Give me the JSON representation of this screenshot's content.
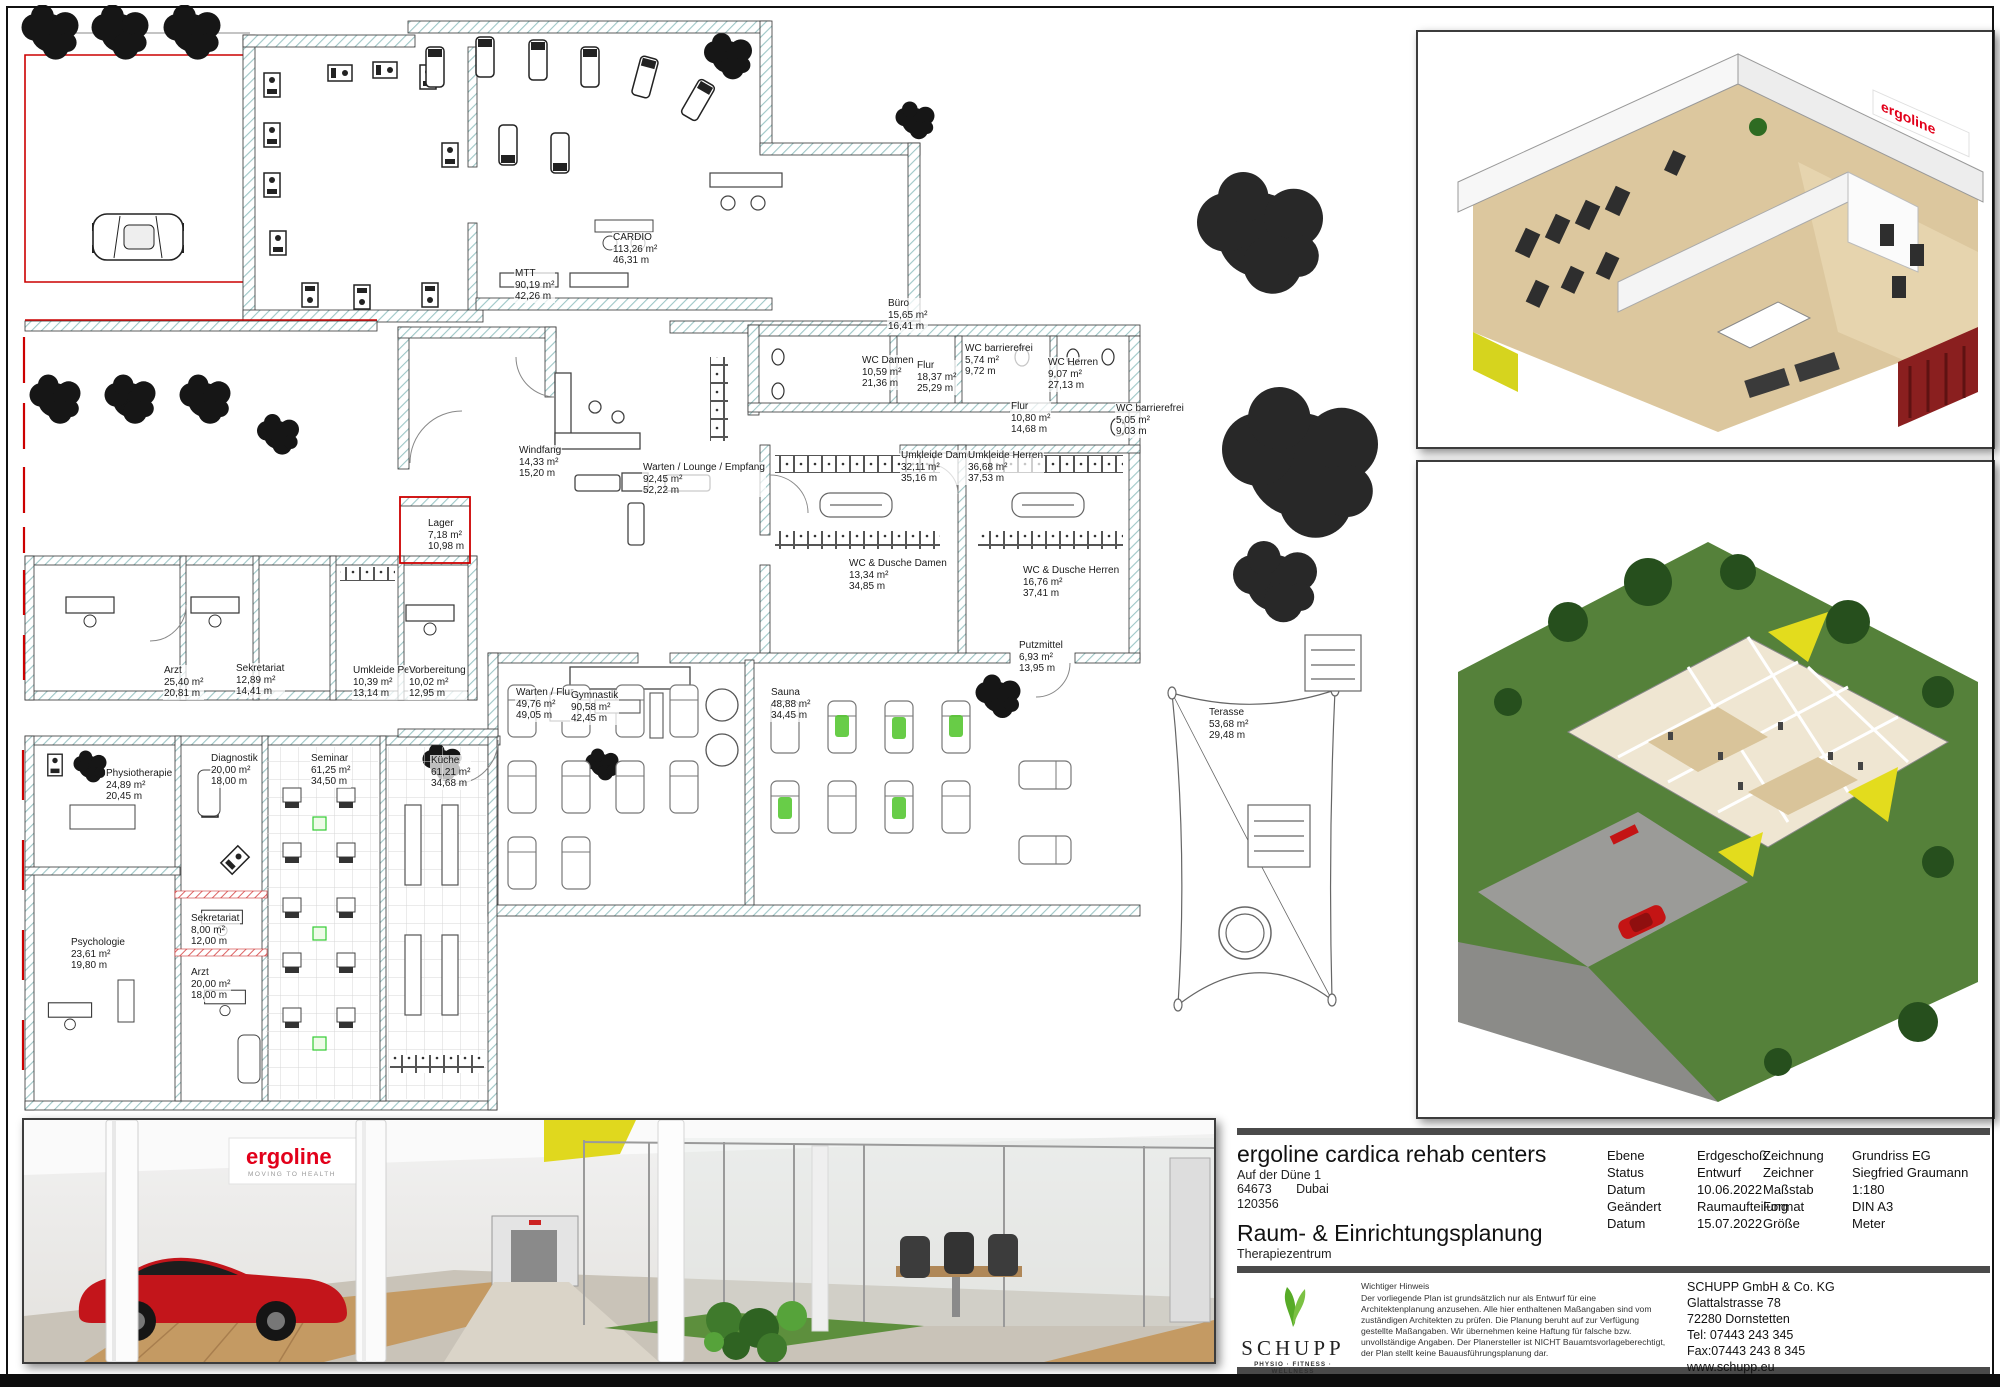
{
  "titleblock": {
    "project_name": "ergoline cardica rehab centers",
    "address_line": "Auf der Düne 1",
    "postal_code": "64673",
    "city": "Dubai",
    "project_number": "120356",
    "plan_title": "Raum- & Einrichtungsplanung",
    "plan_subtitle": "Therapiezentrum",
    "fields_left": [
      {
        "label": "Ebene",
        "value": "Erdgeschoß"
      },
      {
        "label": "Status",
        "value": "Entwurf"
      },
      {
        "label": "Datum",
        "value": "10.06.2022"
      },
      {
        "label": "Geändert",
        "value": "Raumaufteilung"
      },
      {
        "label": "Datum",
        "value": "15.07.2022"
      }
    ],
    "fields_right": [
      {
        "label": "Zeichnung",
        "value": "Grundriss EG"
      },
      {
        "label": "Zeichner",
        "value": "Siegfried Graumann"
      },
      {
        "label": "Maßstab",
        "value": "1:180"
      },
      {
        "label": "Format",
        "value": "DIN A3"
      },
      {
        "label": "Größe",
        "value": "Meter"
      }
    ]
  },
  "company": {
    "logo_name": "SCHUPP",
    "logo_tagline": "PHYSIO · FITNESS · WELLNESS",
    "notice_title": "Wichtiger Hinweis",
    "notice_text": "Der vorliegende Plan ist grundsätzlich nur als Entwurf für eine Architektenplanung anzusehen. Alle hier enthaltenen Maßangaben sind vom zuständigen Architekten zu prüfen. Die Planung beruht auf zur Verfügung gestellte Maßangaben. Wir übernehmen keine Haftung für falsche bzw. unvollständige Angaben. Der Planersteller ist NICHT Bauamtsvorlageberechtigt, der Plan stellt keine Bauausführungsplanung dar.",
    "address": [
      "SCHUPP GmbH & Co. KG",
      "Glattalstrasse 78",
      "72280 Dornstetten",
      "Tel: 07443 243 345",
      "Fax:07443 243 8 345",
      "www.schupp.eu"
    ]
  },
  "legal": "Alle Rechte vorbehalten. Kein Teil dieser Unterlagen darf in irgendeiner Form (Druck, Fotokopie oder einem anderen Verfahren) ohne schriftliche Genehmigung des Erstellers reproduziert oder unter Verwendung elektronischer Systeme verarbeitet, vervielfältigt und an Dritte weitergegeben werden.",
  "brand": {
    "ergoline_logo": "ergoline",
    "ergoline_tagline": "MOVING TO HEALTH",
    "ergoline_red": "#e2001a",
    "schupp_green": "#57ab27"
  },
  "floorplan": {
    "rooms": [
      {
        "name": "MTT",
        "area": "90,19 m²",
        "perimeter": "42,26 m",
        "x": 504,
        "y": 263
      },
      {
        "name": "CARDIO",
        "area": "113,26 m²",
        "perimeter": "46,31 m",
        "x": 602,
        "y": 227
      },
      {
        "name": "Büro",
        "area": "15,65 m²",
        "perimeter": "16,41 m",
        "x": 877,
        "y": 293
      },
      {
        "name": "WC Damen",
        "area": "10,59 m²",
        "perimeter": "21,36 m",
        "x": 851,
        "y": 350
      },
      {
        "name": "Flur",
        "area": "18,37 m²",
        "perimeter": "25,29 m",
        "x": 906,
        "y": 355
      },
      {
        "name": "WC barrierefrei",
        "area": "5,74 m²",
        "perimeter": "9,72 m",
        "x": 954,
        "y": 338
      },
      {
        "name": "WC Herren",
        "area": "9,07 m²",
        "perimeter": "27,13 m",
        "x": 1037,
        "y": 352
      },
      {
        "name": "Flur",
        "area": "10,80 m²",
        "perimeter": "14,68 m",
        "x": 1000,
        "y": 396
      },
      {
        "name": "WC barrierefrei",
        "area": "5,05 m²",
        "perimeter": "9,03 m",
        "x": 1105,
        "y": 398
      },
      {
        "name": "Windfang",
        "area": "14,33 m²",
        "perimeter": "15,20 m",
        "x": 508,
        "y": 440
      },
      {
        "name": "Warten / Lounge / Empfang",
        "area": "92,45 m²",
        "perimeter": "52,22 m",
        "x": 632,
        "y": 457
      },
      {
        "name": "Lager",
        "area": "7,18 m²",
        "perimeter": "10,98 m",
        "x": 417,
        "y": 513
      },
      {
        "name": "Umkleide Damen",
        "area": "32,11 m²",
        "perimeter": "35,16 m",
        "x": 890,
        "y": 445
      },
      {
        "name": "Umkleide Herren",
        "area": "36,68 m²",
        "perimeter": "37,53 m",
        "x": 957,
        "y": 445
      },
      {
        "name": "WC & Dusche Damen",
        "area": "13,34 m²",
        "perimeter": "34,85 m",
        "x": 838,
        "y": 553
      },
      {
        "name": "WC & Dusche Herren",
        "area": "16,76 m²",
        "perimeter": "37,41 m",
        "x": 1012,
        "y": 560
      },
      {
        "name": "Arzt",
        "area": "25,40 m²",
        "perimeter": "20,81 m",
        "x": 153,
        "y": 660
      },
      {
        "name": "Sekretariat",
        "area": "12,89 m²",
        "perimeter": "14,41 m",
        "x": 225,
        "y": 658
      },
      {
        "name": "Umkleide Pers.",
        "area": "10,39 m²",
        "perimeter": "13,14 m",
        "x": 342,
        "y": 660
      },
      {
        "name": "Vorbereitung",
        "area": "10,02 m²",
        "perimeter": "12,95 m",
        "x": 398,
        "y": 660
      },
      {
        "name": "Warten / Flur",
        "area": "49,76 m²",
        "perimeter": "49,05 m",
        "x": 505,
        "y": 682
      },
      {
        "name": "Küche",
        "area": "61,21 m²",
        "perimeter": "34,68 m",
        "x": 420,
        "y": 750
      },
      {
        "name": "Physiotherapie",
        "area": "24,89 m²",
        "perimeter": "20,45 m",
        "x": 95,
        "y": 763
      },
      {
        "name": "Diagnostik",
        "area": "20,00 m²",
        "perimeter": "18,00 m",
        "x": 200,
        "y": 748
      },
      {
        "name": "Seminar",
        "area": "61,25 m²",
        "perimeter": "34,50 m",
        "x": 300,
        "y": 748
      },
      {
        "name": "Gymnastik",
        "area": "90,58 m²",
        "perimeter": "42,45 m",
        "x": 560,
        "y": 685
      },
      {
        "name": "Putzmittel",
        "area": "6,93 m²",
        "perimeter": "13,95 m",
        "x": 1008,
        "y": 635
      },
      {
        "name": "Sauna",
        "area": "48,88 m²",
        "perimeter": "34,45 m",
        "x": 760,
        "y": 682
      },
      {
        "name": "Terasse",
        "area": "53,68 m²",
        "perimeter": "29,48 m",
        "x": 1198,
        "y": 702
      },
      {
        "name": "Psychologie",
        "area": "23,61 m²",
        "perimeter": "19,80 m",
        "x": 60,
        "y": 932
      },
      {
        "name": "Sekretariat",
        "area": "8,00 m²",
        "perimeter": "12,00 m",
        "x": 180,
        "y": 908
      },
      {
        "name": "Arzt",
        "area": "20,00 m²",
        "perimeter": "18,00 m",
        "x": 180,
        "y": 962
      }
    ]
  }
}
